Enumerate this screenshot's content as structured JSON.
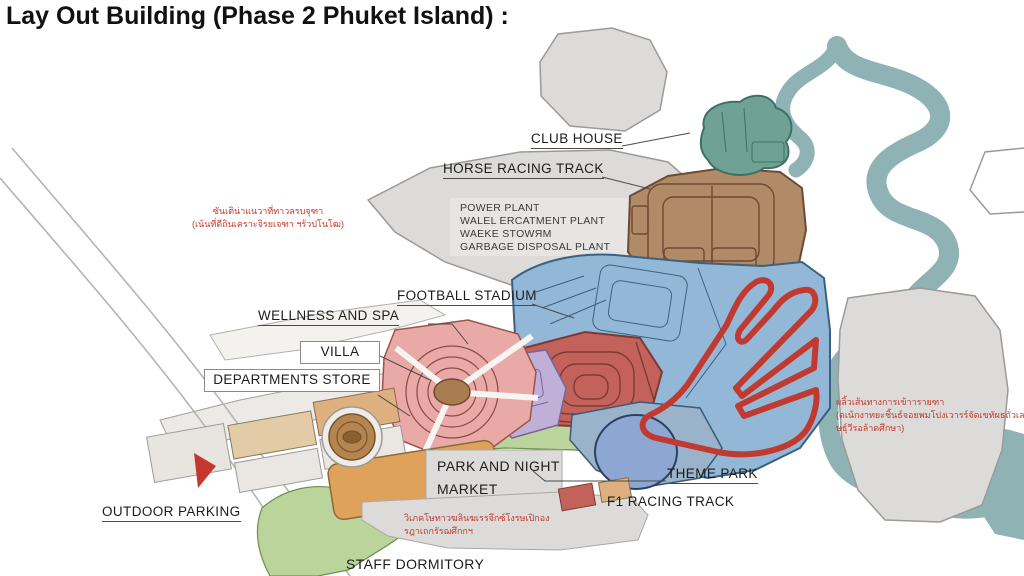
{
  "title": "Lay Out Building (Phase 2 Phuket Island) :",
  "labels": {
    "club_house": "CLUB HOUSE",
    "horse_racing_track": "HORSE RACING TRACK",
    "football_stadium": "FOOTBALL STADIUM",
    "wellness_and_spa": "WELLNESS AND SPA",
    "villa": "VILLA",
    "departments_store": "DEPARTMENTS STORE",
    "park_and_night_market_line1": "PARK AND NIGHT",
    "park_and_night_market_line2": "MARKET",
    "theme_park": "THEME PARK",
    "f1_racing_track": "F1 RACING TRACK",
    "outdoor_parking": "OUTDOOR PARKING",
    "staff_dormitory": "STAFF DORMITORY"
  },
  "power_plant": {
    "line1": "POWER PLANT",
    "line2": "WALEL ERCATMENT PLANT",
    "line3": "WAEKE STOWЯM",
    "line4": "GARBAGE DISPOSAL PLANT"
  },
  "annotations_red": {
    "left_line1": "ซันเติน่าแนวาที่ทาวลรบจุฑา",
    "left_line2": "(เน้นที่ดีถินเคราะจิรยเจฑา ฯร้วปโนโฒ)",
    "right_line1": "ผลิ้วเส้นทางการเข้าารายฑา",
    "right_line2": "(ดเน้กงาทยะชิ้นธ์จอยพมโปงเวารร์จัดเขทัผธถั่วเล)",
    "right_line3": "ษธุ์วีรอล้าดศึกษา)",
    "bottom_line1": "วิเภคโษทาวฆลินฆเรรจึกซ์โงรษเปิกอง",
    "bottom_line2": "รฎาเถกรัรฌศึกกฯ"
  },
  "colors": {
    "background": "#ffffff",
    "land_gray": "#dcdbd9",
    "water_teal": "#8fb3b4",
    "club_house_teal": "#6fa295",
    "power_plant_brown": "#b18a68",
    "stadium_zone_blue": "#93b8d7",
    "stadium_red": "#c3625a",
    "f1_track_red": "#c13a30",
    "park_purple": "#c0b0d8",
    "villa_pink": "#e9a9a6",
    "store_tan": "#dfb07f",
    "market_orange": "#dfa25b",
    "green_area": "#bad49b",
    "theme_park_blue": "#8ea6d2",
    "annotation_red": "#c0392b",
    "label_black": "#1c1c1c"
  }
}
